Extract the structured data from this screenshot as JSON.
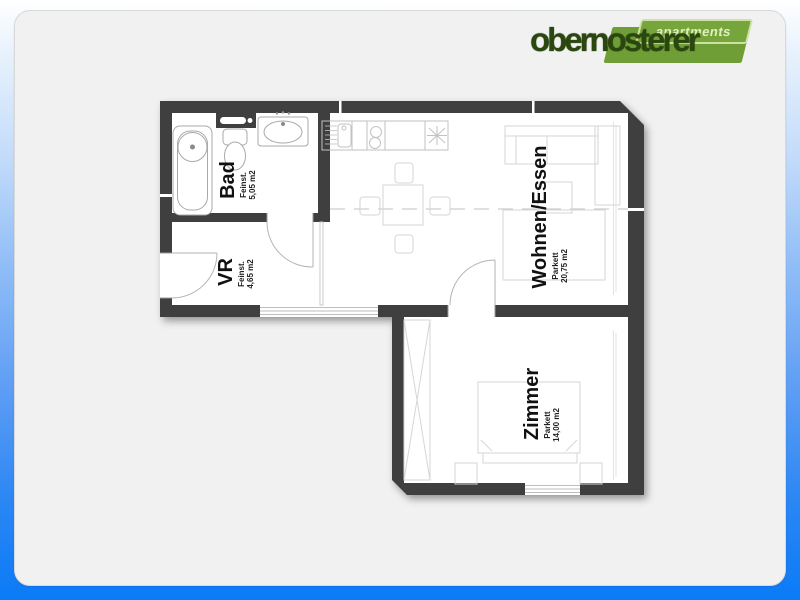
{
  "page": {
    "background_top_color": "#ffffff",
    "background_bottom_color": "#0b7bf7",
    "card_color": "#f1f1f2"
  },
  "logo": {
    "brand": "obernosterer",
    "tagline": "apartments",
    "colors": {
      "brand_dark_green": "#2b470f",
      "banner_green": "#6f9e37",
      "tagline_text": "#dff0bc"
    }
  },
  "floorplan": {
    "wall_color": "#3f3f3f",
    "rooms": {
      "bad": {
        "name": "Bad",
        "floor": "Feinst.",
        "area": "5,05 m2"
      },
      "vr": {
        "name": "VR",
        "floor": "Feinst.",
        "area": "4,65 m2"
      },
      "wohnen_essen": {
        "name": "Wohnen/Essen",
        "floor": "Parkett",
        "area": "20,75 m2"
      },
      "zimmer": {
        "name": "Zimmer",
        "floor": "Parkett",
        "area": "14,00 m2"
      }
    }
  }
}
